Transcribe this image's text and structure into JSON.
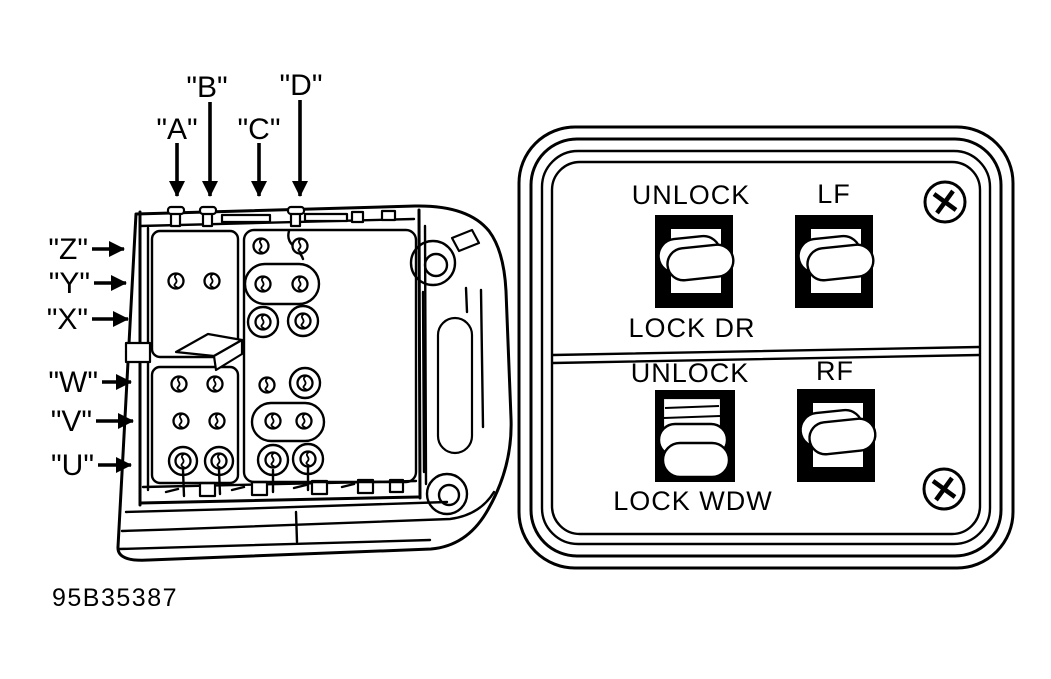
{
  "figure_id": "95B35387",
  "colors": {
    "ink": "#000000",
    "paper": "#ffffff"
  },
  "icons": {
    "screw": "phillips-screw",
    "callout_arrow": "solid-black-arrow",
    "terminal": "bent-pin-terminal"
  },
  "connector": {
    "top_labels": [
      "\"A\"",
      "\"B\"",
      "\"C\"",
      "\"D\""
    ],
    "side_labels": [
      "\"Z\"",
      "\"Y\"",
      "\"X\"",
      "\"W\"",
      "\"V\"",
      "\"U\""
    ]
  },
  "panel": {
    "door_section": {
      "top": "UNLOCK",
      "right": "LF",
      "bottom": "LOCK DR"
    },
    "window_section": {
      "top": "UNLOCK",
      "right": "RF",
      "bottom": "LOCK WDW"
    }
  }
}
